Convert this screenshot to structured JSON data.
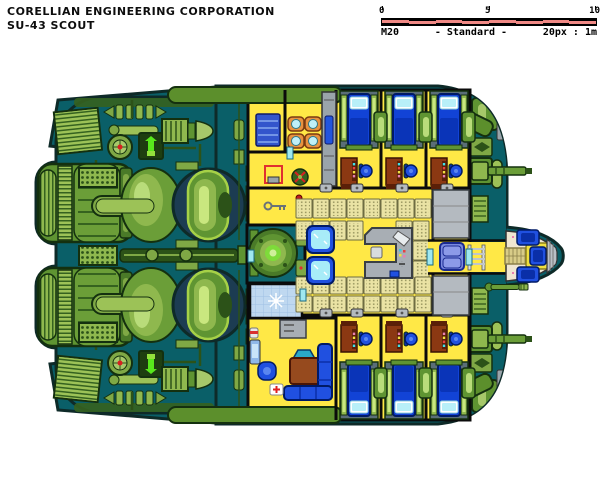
{
  "header": {
    "company": "CORELLIAN ENGINEERING CORPORATION",
    "model": "SU-43 SCOUT"
  },
  "scale_bar": {
    "tick_labels": [
      "0",
      "5",
      "10"
    ],
    "map_code": "M20",
    "standard_label": "- Standard -",
    "ratio_label": "20px : 1m"
  },
  "palette": {
    "hull_teal": "#0A5F68",
    "hull_outline": "#0E2A28",
    "hull_band_green": "#5C8F2C",
    "engine_green_dark": "#2C5218",
    "engine_green_mid": "#5F9432",
    "engine_green_light": "#8FB84E",
    "engine_green_pale": "#C9E77F",
    "engine_glow": "#58E81C",
    "dome_ring_navy": "#1C3C52",
    "deck_yellow": "#FFE846",
    "wall_black": "#0B0B0B",
    "crate_tan": "#EAE3A4",
    "crate_dot": "#97945E",
    "bed_blue": "#1243D6",
    "pillow_cyan": "#B8F0F8",
    "desk_brown": "#8B3812",
    "sofa_blue": "#2050E0",
    "table_brown": "#964A1E",
    "refresher_blue": "#BFD8F0",
    "cockpit_cream": "#EFE6D2",
    "cockpit_speckle_pink": "#E87FB0",
    "console_gray": "#A8AEB4",
    "seat_periwinkle": "#7A8ADE",
    "chair_orange": "#E8923F",
    "accent_red": "#D82020",
    "reactor_core_green": "#7EDB3A",
    "scale_bar_red": "#F08985"
  }
}
